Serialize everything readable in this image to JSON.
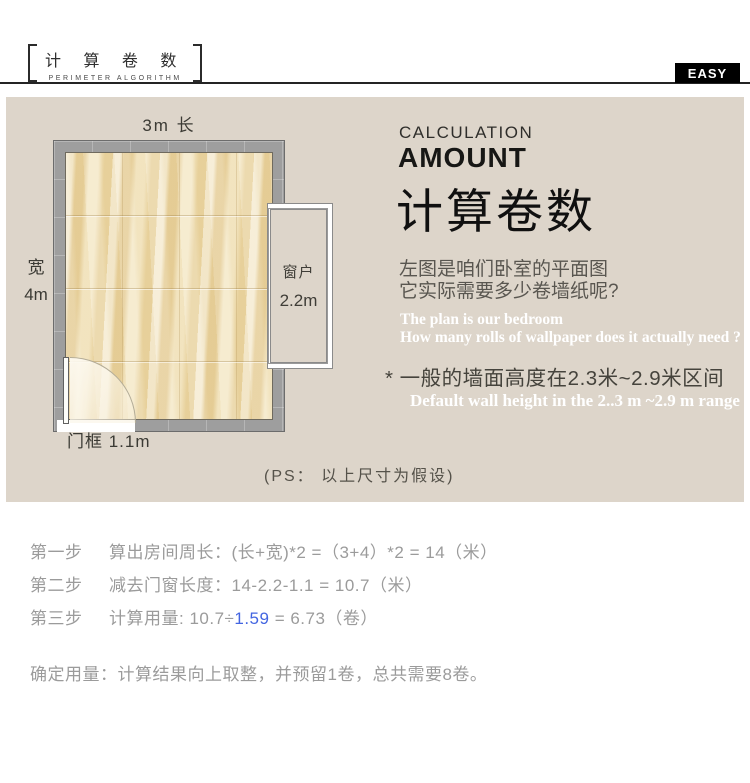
{
  "header": {
    "brand_cn": "计 算 卷 数",
    "brand_en": "PERIMETER ALGORITHM",
    "badge": "EASY"
  },
  "panel": {
    "floorplan": {
      "top_label": "3m 长",
      "left_label_line1": "宽",
      "left_label_line2": "4m",
      "window_label": "窗户",
      "window_size": "2.2m",
      "door_label": "门框 1.1m",
      "ps_note": "(PS： 以上尺寸为假设)"
    },
    "headline": {
      "en_line1": "CALCULATION",
      "en_line2": "AMOUNT",
      "cn": "计算卷数"
    },
    "desc_cn_line1": "左图是咱们卧室的平面图",
    "desc_cn_line2": "它实际需要多少卷墙纸呢?",
    "desc_en_line1": "The plan is our bedroom",
    "desc_en_line2": "How many rolls of wallpaper does it actually need ?",
    "note_cn": "* 一般的墙面高度在2.3米~2.9米区间",
    "note_en": "Default wall height in the 2..3 m ~2.9 m range"
  },
  "steps": [
    {
      "label": "第一步",
      "text": "算出房间周长：(长+宽)*2 =（3+4）*2 = 14（米）"
    },
    {
      "label": "第二步",
      "text": "减去门窗长度：14-2.2-1.1 = 10.7（米）"
    },
    {
      "label": "第三步",
      "pre": "计算用量: 10.7÷",
      "highlight": "1.59",
      "post": " = 6.73（卷）"
    }
  ],
  "conclusion": "确定用量：计算结果向上取整，并预留1卷，总共需要8卷。",
  "colors": {
    "panel_bg": "#ddd5ca",
    "wall_gray": "#9e9e9e",
    "floor_beige": "#eeddb0",
    "badge_bg": "#000000",
    "highlight_blue": "#4365e1",
    "step_text_gray": "#9b9b9b"
  }
}
